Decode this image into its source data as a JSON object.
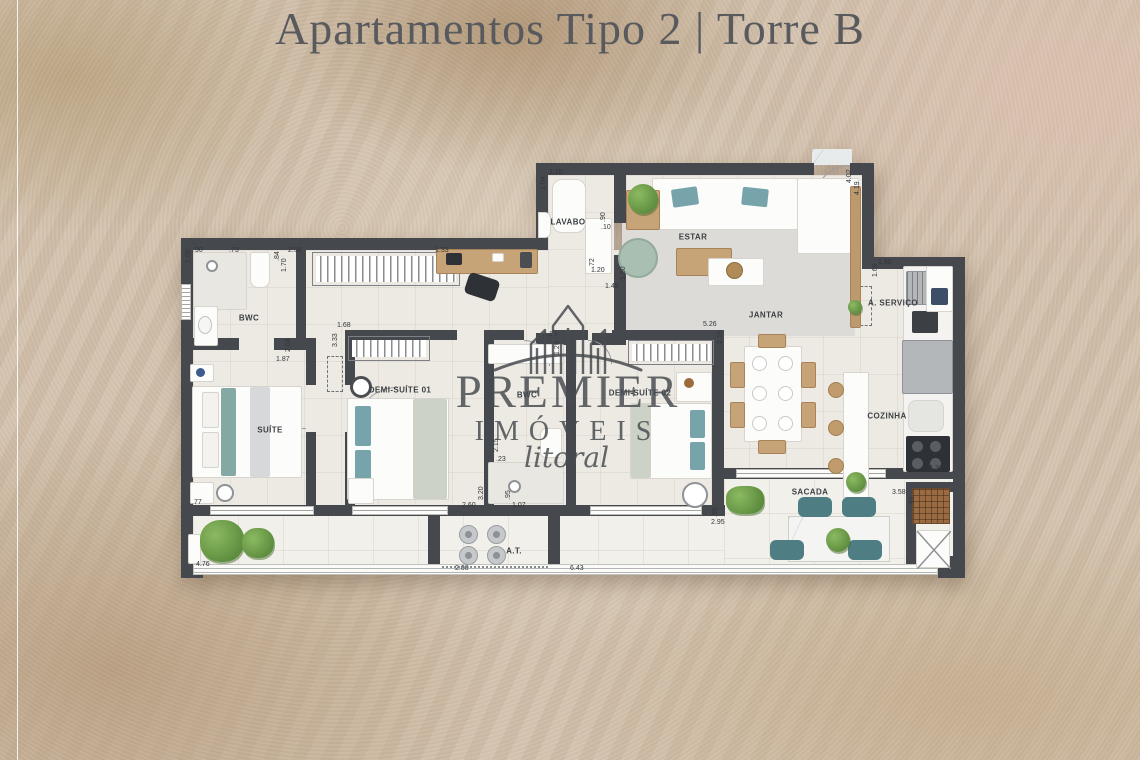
{
  "title": {
    "text": "Apartamentos Tipo 2 | Torre B"
  },
  "watermark": {
    "brand_top": "PREMIER",
    "brand_bottom": "IMÓVEIS",
    "script": "litoral"
  },
  "rooms": {
    "bwc_suite": "BWC",
    "suite": "SUÍTE",
    "lavabo": "LAVABO",
    "estar": "ESTAR",
    "jantar": "JANTAR",
    "servico": "A. SERVIÇO",
    "cozinha": "COZINHA",
    "demi1": "DEMI-SUÍTE 01",
    "bwc_social": "BWC",
    "demi2": "DEMI-SUÍTE 02",
    "sacada": "SACADA",
    "at": "A.T."
  },
  "measurements": [
    {
      "t": "1.10",
      "x": 549,
      "y": 169,
      "r": 0
    },
    {
      "t": "1.04",
      "x": 540,
      "y": 190,
      "r": 1
    },
    {
      "t": ".90",
      "x": 600,
      "y": 222,
      "r": 1
    },
    {
      "t": ".10",
      "x": 601,
      "y": 224,
      "r": 0
    },
    {
      "t": ".72",
      "x": 589,
      "y": 268,
      "r": 1
    },
    {
      "t": "1.20",
      "x": 591,
      "y": 267,
      "r": 0
    },
    {
      "t": "1.48",
      "x": 605,
      "y": 283,
      "r": 0
    },
    {
      "t": "1.50",
      "x": 620,
      "y": 280,
      "r": 1
    },
    {
      "t": "2.58",
      "x": 288,
      "y": 247,
      "r": 0
    },
    {
      "t": ".84",
      "x": 274,
      "y": 261,
      "r": 1
    },
    {
      "t": "1.70",
      "x": 281,
      "y": 272,
      "r": 1
    },
    {
      "t": ".90",
      "x": 193,
      "y": 247,
      "r": 0
    },
    {
      "t": "1.00",
      "x": 185,
      "y": 263,
      "r": 1
    },
    {
      "t": ".73",
      "x": 229,
      "y": 247,
      "r": 0
    },
    {
      "t": "1.33",
      "x": 435,
      "y": 247,
      "r": 0
    },
    {
      "t": "1.68",
      "x": 337,
      "y": 322,
      "r": 0
    },
    {
      "t": "3.33",
      "x": 332,
      "y": 347,
      "r": 1
    },
    {
      "t": "2.04",
      "x": 285,
      "y": 352,
      "r": 1
    },
    {
      "t": "1.87",
      "x": 276,
      "y": 356,
      "r": 0
    },
    {
      "t": "1.10",
      "x": 543,
      "y": 331,
      "r": 0
    },
    {
      "t": "1.20",
      "x": 554,
      "y": 355,
      "r": 1
    },
    {
      "t": "5.26",
      "x": 703,
      "y": 321,
      "r": 0
    },
    {
      "t": "2.15",
      "x": 717,
      "y": 344,
      "r": 1
    },
    {
      "t": "2.15",
      "x": 493,
      "y": 452,
      "r": 1
    },
    {
      "t": ".23",
      "x": 496,
      "y": 456,
      "r": 0
    },
    {
      "t": "3.20",
      "x": 478,
      "y": 500,
      "r": 1
    },
    {
      "t": "2.60",
      "x": 462,
      "y": 502,
      "r": 0
    },
    {
      "t": ".95",
      "x": 505,
      "y": 500,
      "r": 1
    },
    {
      "t": "1.07",
      "x": 512,
      "y": 502,
      "r": 0
    },
    {
      "t": "2.00",
      "x": 455,
      "y": 565,
      "r": 0
    },
    {
      "t": "6.43",
      "x": 570,
      "y": 565,
      "r": 0
    },
    {
      "t": "4.76",
      "x": 196,
      "y": 561,
      "r": 0
    },
    {
      "t": ".77",
      "x": 192,
      "y": 499,
      "r": 0
    },
    {
      "t": ".95",
      "x": 712,
      "y": 517,
      "r": 1
    },
    {
      "t": "2.95",
      "x": 711,
      "y": 519,
      "r": 0
    },
    {
      "t": "3.58",
      "x": 892,
      "y": 489,
      "r": 0
    },
    {
      "t": ".91",
      "x": 909,
      "y": 506,
      "r": 1
    },
    {
      "t": "4.33",
      "x": 929,
      "y": 465,
      "r": 0
    },
    {
      "t": "1.50",
      "x": 878,
      "y": 259,
      "r": 0
    },
    {
      "t": "1.69",
      "x": 872,
      "y": 277,
      "r": 1
    },
    {
      "t": "4.02",
      "x": 846,
      "y": 183,
      "r": 1
    },
    {
      "t": "4.19",
      "x": 854,
      "y": 195,
      "r": 1
    }
  ]
}
